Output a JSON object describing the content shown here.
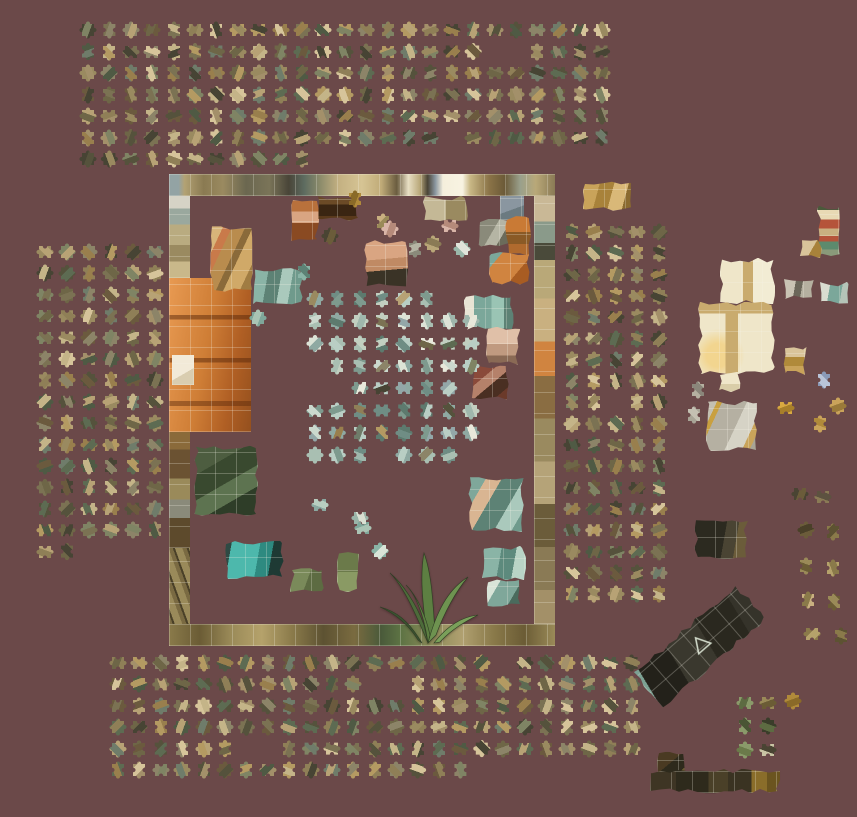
{
  "scene": {
    "width": 857,
    "height": 817,
    "background": "#6B4949",
    "description": "Jigsaw puzzle game in progress: partially assembled painting border on center board, loose pieces sorted in trays around it"
  },
  "palettes": {
    "warm": [
      "#8f7f57",
      "#6e6647",
      "#9a8a60",
      "#b7a275",
      "#55523c",
      "#7b7253",
      "#474434",
      "#c4b488",
      "#7f8464",
      "#5d6b52",
      "#a3906a",
      "#6b5a3e",
      "#8c8468",
      "#b49a62",
      "#4f5a44",
      "#997f4d",
      "#d6c49a",
      "#6f7c6a"
    ],
    "cool": [
      "#9fb7ac",
      "#b9cec4",
      "#7e9a8e",
      "#cbd8cd",
      "#8fa9a2",
      "#a9bfb2",
      "#dce3d6",
      "#6f8d84",
      "#93a7a8",
      "#c2cfc0",
      "#5d7a6e",
      "#e8e8da"
    ]
  },
  "board": {
    "x": 169,
    "y": 174,
    "w": 386,
    "h": 472,
    "segments": [
      {
        "name": "assembled-border-top",
        "x": 0,
        "y": 0,
        "w": 386,
        "h": 22,
        "bg": "linear-gradient(90deg,#93a3a4 0%,#93a3a4 2.5%,#b3a274 4%,#8a7a52 9%,#9a8a60 14%,#6b6750 20%,#7a7458 26%,#494538 31%,#5d6b60 35%,#8a8a6a 39%,#c4b182 44%,#d6c494 50%,#c0ab78 55%,#6b5d40 59%,#e8dfc4 62%,#b9a87a 65%,#4a4436 67%,#8a96a0 69%,#f5efdc 71%,#f8f3e2 76%,#c9b886 78%,#8a7347 83%,#6b5a38 87%,#9aa08c 91%,#b9a878 95%,#8a7a55 100%)"
      },
      {
        "name": "assembled-attached-piece",
        "x": 331,
        "y": 22,
        "w": 24,
        "h": 24,
        "bg": "linear-gradient(160deg,#8a96a0 0 55%,#6b7a80 55%)"
      },
      {
        "name": "assembled-border-left-top",
        "x": 0,
        "y": 22,
        "w": 21,
        "h": 82,
        "bg": "linear-gradient(180deg,#d6d3c6 0 15%,#9aa89e 15% 35%,#b9ab80 35% 60%,#9a8a60 60% 80%,#c9b88a 80%)"
      },
      {
        "name": "assembled-dresser",
        "x": 0,
        "y": 104,
        "w": 82,
        "h": 154,
        "bg": "linear-gradient(180deg,rgba(0,0,0,0) 0 24%,rgba(90,40,10,0.5) 24% 27%,rgba(0,0,0,0) 27% 52%,rgba(90,40,10,0.5) 52% 55%,rgba(0,0,0,0) 55% 80%,rgba(90,40,10,0.45) 80% 83%,rgba(0,0,0,0) 83%),linear-gradient(100deg,#e89a52 0%,#cf7e36 45%,#b05f24 75%,#94501e 100%)"
      },
      {
        "name": "assembled-dresser-paper",
        "x": 3,
        "y": 181,
        "w": 22,
        "h": 30,
        "bg": "linear-gradient(150deg,#f2ead8 0 60%,#d9cdb0 60%)"
      },
      {
        "name": "assembled-border-left-mid",
        "x": 0,
        "y": 258,
        "w": 21,
        "h": 116,
        "bg": "linear-gradient(180deg,#8a6a3a 0 15%,#6b5232 15% 40%,#9a8a5a 40% 58%,#8a8a7a 58% 74%,#5d4a2c 74%)"
      },
      {
        "name": "assembled-border-left-bottom",
        "x": 0,
        "y": 374,
        "w": 21,
        "h": 98,
        "bg": "repeating-linear-gradient(70deg,#9a8a5a 0 7px,#7a6a42 7px 11px,#4a4028 11px 13px)"
      },
      {
        "name": "assembled-border-right",
        "x": 365,
        "y": 22,
        "w": 21,
        "h": 428,
        "bg": "linear-gradient(180deg,#c9b896 0 6%,#8a9a8a 6% 11%,#4a4a3a 11% 15%,#b9a878 15% 24%,#c9b080 24% 34%,#d08440 34% 42%,#8a6d42 42% 52%,#9a8a5f 52% 62%,#b5a378 62% 72%,#6b5c3a 72% 82%,#8a7a55 82% 92%,#a39068 92%)"
      },
      {
        "name": "assembled-border-bottom",
        "x": 0,
        "y": 450,
        "w": 386,
        "h": 22,
        "bg": "linear-gradient(90deg,#8a7a4a 0,#6b5c35 8%,#9a8a58 16%,#b5a26b 24%,#8a7a4a 32%,#5d5232 40%,#7a6b40 48%,#4a5a3a 55%,#5d7344 60%,#8a8a58 68%,#b0a070 76%,#8a7a4a 84%,#6b5c35 92%,#9a8a58 100%)"
      }
    ]
  },
  "center_grid": {
    "x": 315,
    "y": 299,
    "cols": 8,
    "rows": 8,
    "dx": 22.3,
    "dy": 22.3,
    "palette": "cool",
    "gaps": [
      [
        6,
        0
      ],
      [
        7,
        0
      ],
      [
        0,
        3
      ],
      [
        0,
        4
      ],
      [
        1,
        4
      ],
      [
        7,
        4
      ],
      [
        3,
        7
      ],
      [
        7,
        7
      ]
    ]
  },
  "trays": [
    {
      "name": "tray-top",
      "x": 88,
      "y": 30,
      "cols": 25,
      "rows": 7,
      "dx": 21.4,
      "dy": 21.5,
      "palette": "warm",
      "gapRanges": [
        [
          6,
          11,
          24
        ],
        [
          1,
          19,
          20
        ],
        [
          5,
          17,
          17
        ]
      ]
    },
    {
      "name": "tray-left",
      "x": 45,
      "y": 252,
      "cols": 6,
      "rows": 15,
      "dx": 22,
      "dy": 21.4,
      "palette": "warm",
      "gapRanges": [
        [
          14,
          2,
          5
        ]
      ]
    },
    {
      "name": "tray-right",
      "x": 572,
      "y": 232,
      "cols": 5,
      "rows": 18,
      "dx": 21.8,
      "dy": 21.3,
      "palette": "warm",
      "gapRanges": [
        [
          8,
          2,
          2
        ]
      ]
    },
    {
      "name": "tray-bottom",
      "x": 118,
      "y": 663,
      "cols": 25,
      "rows": 6,
      "dx": 21.4,
      "dy": 21.4,
      "palette": "warm",
      "gapRanges": [
        [
          5,
          17,
          24
        ],
        [
          1,
          12,
          13
        ],
        [
          4,
          6,
          7
        ],
        [
          0,
          18,
          18
        ]
      ]
    }
  ],
  "clusters": [
    {
      "name": "cluster-wood",
      "x": 210,
      "y": 226,
      "w": 44,
      "h": 66,
      "bg": "linear-gradient(115deg,#d8b57a 0 18%,#c97a4a 18% 30%,#b98c4e 30% 48%,#8a6a3a 48% 58%,#d0a968 58% 80%,#a07c42 80%)"
    },
    {
      "name": "cluster-teal-pot",
      "x": 253,
      "y": 268,
      "w": 50,
      "h": 38,
      "bg": "linear-gradient(100deg,#8ab4a6 0 28%,#5d8275 28% 52%,#aac9bc 52% 72%,#6f9a8c 72%)"
    },
    {
      "name": "cluster-red-chair",
      "x": 291,
      "y": 199,
      "w": 28,
      "h": 44,
      "bg": "linear-gradient(180deg,#b9713c 0 28%,#d9a582 28% 55%,#8a4a22 55%)"
    },
    {
      "name": "cluster-dresser-top",
      "x": 316,
      "y": 196,
      "w": 44,
      "h": 25,
      "bg": "linear-gradient(180deg,#6b4a26 0 35%,#3a2512 35% 80%,#5a3a1c 80%)"
    },
    {
      "name": "cluster-peach-boot",
      "x": 364,
      "y": 240,
      "w": 44,
      "h": 48,
      "bg": "linear-gradient(175deg,#d9a582 0 40%,#c08a64 40% 62%,#3a3326 62%)"
    },
    {
      "name": "cluster-tan-pair-top",
      "x": 423,
      "y": 196,
      "w": 46,
      "h": 26,
      "bg": "linear-gradient(90deg,#c4b896 0 50%,#9a8a60 50%)"
    },
    {
      "name": "cluster-grey-pair",
      "x": 478,
      "y": 219,
      "w": 32,
      "h": 28,
      "bg": "linear-gradient(120deg,#8a8a7a 0 45%,#b5b5a4 45% 70%,#6b6b5a 70%)"
    },
    {
      "name": "cluster-orange-tall",
      "x": 505,
      "y": 216,
      "w": 26,
      "h": 40,
      "bg": "linear-gradient(180deg,#c97a35 0 40%,#8a5a26 40% 70%,#b06a2e 70%)"
    },
    {
      "name": "cluster-orange-bowl",
      "x": 489,
      "y": 252,
      "w": 42,
      "h": 33,
      "bg": "linear-gradient(130deg,#7ba79a 0 20%,#d08440 20% 65%,#a85c22 65%)"
    },
    {
      "name": "cluster-teal-white",
      "x": 464,
      "y": 294,
      "w": 50,
      "h": 36,
      "bg": "linear-gradient(90deg,#e8e4d4 0 20%,#7ba79a 20% 55%,#9ac4b4 55% 80%,#5d8275 80%)"
    },
    {
      "name": "cluster-peach-vase",
      "x": 486,
      "y": 327,
      "w": 34,
      "h": 38,
      "bg": "linear-gradient(180deg,#e0c0a8 0 45%,#c09a80 45% 75%,#8a6a55 75%)"
    },
    {
      "name": "cluster-red-pot",
      "x": 471,
      "y": 364,
      "w": 38,
      "h": 36,
      "bg": "linear-gradient(140deg,#8a4a3a 0 35%,#b5816a 35% 55%,#4a2f22 55% 80%,#6b3a2a 80%)"
    },
    {
      "name": "cluster-teal-patch",
      "x": 468,
      "y": 476,
      "w": 56,
      "h": 56,
      "bg": "linear-gradient(120deg,#7fa79a 0 22%,#d9b592 22% 40%,#5d8275 40% 65%,#aac9bc 65% 85%,#6f9a8c 85%)"
    },
    {
      "name": "cluster-teal-low1",
      "x": 482,
      "y": 546,
      "w": 44,
      "h": 34,
      "bg": "linear-gradient(100deg,#8ab4a6 0 40%,#5d8a7d 40% 70%,#b9d4c6 70%)"
    },
    {
      "name": "cluster-teal-low2",
      "x": 486,
      "y": 578,
      "w": 36,
      "h": 30,
      "bg": "linear-gradient(120deg,#d9e4d8 0 30%,#7fa79a 30% 70%,#4a6b5d 70%)"
    },
    {
      "name": "cluster-green-dark",
      "x": 194,
      "y": 446,
      "w": 64,
      "h": 70,
      "bg": "linear-gradient(150deg,#4d5d40 0 28%,#39492f 28% 52%,#5d7350 52% 72%,#2e3d28 72%)"
    },
    {
      "name": "cluster-teal-bright",
      "x": 224,
      "y": 541,
      "w": 60,
      "h": 38,
      "bg": "linear-gradient(100deg,#2e4a44 0 12%,#4db8ac 12% 55%,#2e8a80 55% 75%,#1e3a34 75%)"
    },
    {
      "name": "cluster-olive-pair",
      "x": 290,
      "y": 568,
      "w": 34,
      "h": 26,
      "bg": "linear-gradient(110deg,#7a8a5a 0 50%,#5d6b42 50%)"
    },
    {
      "name": "cluster-olive-tall",
      "x": 337,
      "y": 552,
      "w": 22,
      "h": 40,
      "bg": "linear-gradient(180deg,#6b7a4a 0 50%,#8a9a64 50%)"
    },
    {
      "name": "cluster-gold-L",
      "x": 583,
      "y": 181,
      "w": 50,
      "h": 30,
      "bg": "linear-gradient(105deg,#c9a35a 0 30%,#a8823a 30% 55%,#d9b878 55% 80%,#8a6a30 80%)"
    },
    {
      "name": "cluster-color-strip",
      "x": 817,
      "y": 205,
      "w": 25,
      "h": 52,
      "bg": "linear-gradient(180deg,#4a5a3a 0 10%,#e8d9b4 10% 28%,#b5543a 28% 45%,#c9b080 45% 60%,#b5543a 60% 70%,#5d8a6d 70% 86%,#8a9a7a 86%)"
    },
    {
      "name": "cluster-tan-small",
      "x": 800,
      "y": 238,
      "w": 22,
      "h": 20,
      "bg": "linear-gradient(120deg,#d9c49a 0 55%,#a8823a 55%)"
    },
    {
      "name": "cluster-grey-pair-2",
      "x": 782,
      "y": 278,
      "w": 32,
      "h": 22,
      "bg": "linear-gradient(100deg,#c9c4b4 0 40%,#6b675a 40% 60%,#b5b0a0 60%)"
    },
    {
      "name": "cluster-teal-pair",
      "x": 818,
      "y": 282,
      "w": 32,
      "h": 22,
      "bg": "linear-gradient(100deg,#d9dcd0 0 35%,#7ba79a 35% 70%,#b5c4b8 70%)"
    },
    {
      "name": "cluster-window-top",
      "x": 720,
      "y": 258,
      "w": 55,
      "h": 46,
      "bg": "linear-gradient(90deg,#efe6c9 0 42%,#c9ab6e 42% 60%,#f2ecd4 60%)"
    },
    {
      "name": "cluster-window-main",
      "x": 698,
      "y": 302,
      "w": 77,
      "h": 72,
      "bg": "linear-gradient(90deg,rgba(201,171,110,0) 0 36%,#c9ab6e 36% 52%,rgba(201,171,110,0) 52%),radial-gradient(circle at 26% 74%,rgba(242,212,140,0.95) 0 15%,rgba(242,212,140,0) 34%),linear-gradient(180deg,#c9ab6e 0 16%,#efe6c9 16%)"
    },
    {
      "name": "cluster-window-tab",
      "x": 718,
      "y": 372,
      "w": 24,
      "h": 20,
      "bg": "linear-gradient(180deg,#efe6c9 0 60%,#d9cda8 60%)"
    },
    {
      "name": "cluster-tan-pair-right",
      "x": 783,
      "y": 345,
      "w": 24,
      "h": 30,
      "bg": "linear-gradient(180deg,#d9c49a 0 40%,#b08a3a 40% 70%,#c9a35a 70%)"
    },
    {
      "name": "cluster-grey-patch",
      "x": 706,
      "y": 401,
      "w": 52,
      "h": 50,
      "bg": "linear-gradient(115deg,#c4c0b2 0 15%,#c9a040 15% 22%,#b5b0a2 22% 55%,#d6d3c6 55% 78%,#c9a35a 78% 88%,#a8a496 88%)"
    },
    {
      "name": "cluster-dark-small",
      "x": 694,
      "y": 519,
      "w": 54,
      "h": 40,
      "bg": "linear-gradient(100deg,#2c2a20 0 55%,#4a4433 55% 75%,#6b5c3a 75%)"
    },
    {
      "name": "cluster-chalkboard",
      "x": 631,
      "y": 622,
      "w": 138,
      "h": 48,
      "rot": -41,
      "glyph": "triangle",
      "glyph_color": "#cfd8c8",
      "bg": "linear-gradient(100deg,#7ca193 0 5%,#23211a 5% 30%,#3a382e 30% 56%,#2a281f 56% 84%,#35332a 84%)"
    },
    {
      "name": "cluster-strip-stub",
      "x": 657,
      "y": 752,
      "w": 30,
      "h": 30,
      "bg": "linear-gradient(140deg,#4a3a22 0 40%,#2e2a1c 40% 70%,#6b5c33 70%)"
    },
    {
      "name": "cluster-strip-bar",
      "x": 650,
      "y": 769,
      "w": 130,
      "h": 24,
      "bg": "linear-gradient(90deg,#3e3524 0 20%,#2e2a1c 20% 45%,#4a4028 45% 60%,#3a3322 60% 78%,#8a6d2a 78% 90%,#6b541f 90%)"
    }
  ],
  "plant": {
    "x": 372,
    "y": 545,
    "w": 112,
    "h": 100,
    "colors": [
      "#4d6b3a",
      "#5d7f42",
      "#6e9350",
      "#3a5230",
      "#7aa05a"
    ]
  },
  "loose_pieces": [
    [
      383,
      222,
      "#c9b080",
      "#9a8a58"
    ],
    [
      390,
      229,
      "#d9b5a8",
      "#b58a7a"
    ],
    [
      450,
      226,
      "#d9b5a8",
      "#b58a7a"
    ],
    [
      415,
      249,
      "#8a8a7a",
      "#b5b5a4"
    ],
    [
      433,
      244,
      "#b9a678",
      "#8a7a55"
    ],
    [
      462,
      249,
      "#9ab8aa",
      "#e0e4da"
    ],
    [
      355,
      199,
      "#b08a3a",
      "#8a6a28"
    ],
    [
      330,
      236,
      "#4a4433",
      "#6b5c3a"
    ],
    [
      304,
      272,
      "#8ab4a6",
      "#5d8275"
    ],
    [
      258,
      318,
      "#7fa79a",
      "#aac4b4"
    ],
    [
      363,
      528,
      "#7fa79a",
      "#aac4b4"
    ],
    [
      380,
      551,
      "#8ab4a6",
      "#d9e4d8"
    ],
    [
      320,
      505,
      "#8aa8a0",
      "#b9cec0"
    ],
    [
      360,
      518,
      "#9ab4a8",
      "#d9e0d2"
    ],
    [
      698,
      390,
      "#b5b0a0",
      "#8a867a"
    ],
    [
      694,
      415,
      "#a8a496",
      "#c4c0b2"
    ],
    [
      786,
      408,
      "#d9a940",
      "#a87f2a"
    ],
    [
      838,
      406,
      "#c9a35a",
      "#9a7a3a"
    ],
    [
      820,
      424,
      "#c9a35a",
      "#b08a3a"
    ],
    [
      824,
      380,
      "#8a9ab8",
      "#b9c4d8"
    ],
    [
      800,
      494,
      "#4a4433",
      "#6b5c3a"
    ],
    [
      823,
      497,
      "#8a7a55",
      "#5d5240"
    ],
    [
      806,
      530,
      "#6b5c3a",
      "#4a4028"
    ],
    [
      833,
      532,
      "#8a7a4a",
      "#5d5232"
    ],
    [
      806,
      566,
      "#9a8a58",
      "#6b5c35"
    ],
    [
      833,
      568,
      "#b5a26b",
      "#8a7a4a"
    ],
    [
      808,
      600,
      "#c9b080",
      "#8a7a4a"
    ],
    [
      834,
      602,
      "#6b5c35",
      "#9a8a58"
    ],
    [
      812,
      634,
      "#8a7a4a",
      "#b5a26b"
    ],
    [
      841,
      636,
      "#5d5232",
      "#8a7a4a"
    ],
    [
      745,
      703,
      "#8a9a6a",
      "#5d6b42"
    ],
    [
      768,
      703,
      "#9a8a58",
      "#6b5c35"
    ],
    [
      793,
      701,
      "#b08a3a",
      "#8a6a28"
    ],
    [
      745,
      726,
      "#8a9a6a",
      "#4a5534"
    ],
    [
      768,
      726,
      "#3a3d2a",
      "#5d6b42"
    ],
    [
      745,
      750,
      "#8a9a6a",
      "#6b7a4a"
    ],
    [
      768,
      750,
      "#c9c4a4",
      "#4a4433"
    ]
  ]
}
